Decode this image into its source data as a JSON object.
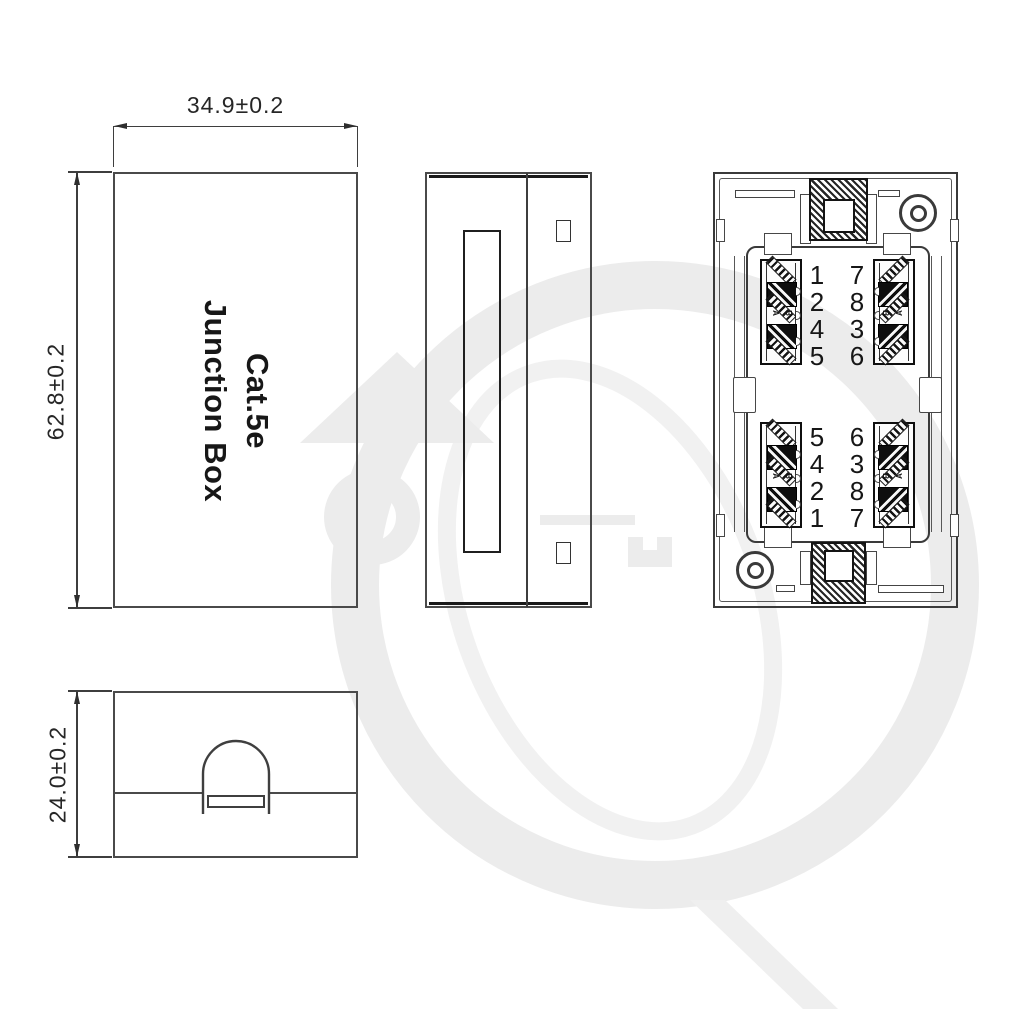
{
  "drawing": {
    "title": "Cat.5e Junction Box engineering drawing",
    "front_label": {
      "line1": "Cat.5e",
      "line2": "Junction Box"
    },
    "dimensions": {
      "width": "34.9±0.2",
      "height": "62.8±0.2",
      "depth": "24.0±0.2"
    },
    "internal_view": {
      "top_left_ports": [
        "1",
        "2",
        "4",
        "5"
      ],
      "top_right_ports": [
        "7",
        "8",
        "3",
        "6"
      ],
      "bottom_left_ports": [
        "5",
        "4",
        "2",
        "1"
      ],
      "bottom_right_ports": [
        "6",
        "3",
        "8",
        "7"
      ],
      "wiring_label_a": "A",
      "wiring_label_b": "B"
    },
    "colors": {
      "line": "#3e3e3e",
      "text": "#1f1f1f",
      "watermark": "#ececec"
    }
  }
}
